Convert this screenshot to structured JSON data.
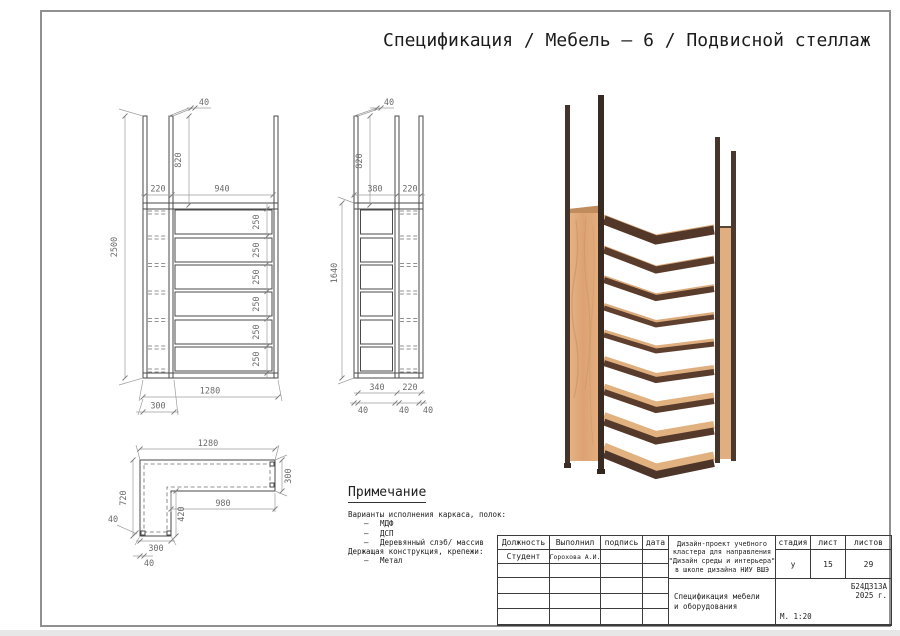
{
  "page": {
    "title": "Спецификация / Мебель – 6 / Подвисной стеллаж"
  },
  "views": {
    "front": {
      "d40": "40",
      "d820": "820",
      "d220": "220",
      "d940": "940",
      "d2500": "2500",
      "d250": "250",
      "d1280": "1280",
      "d300": "300"
    },
    "side": {
      "d40": "40",
      "d820": "820",
      "d380": "380",
      "d220": "220",
      "d1640": "1640",
      "d340": "340",
      "d220b": "220",
      "d40b": "40"
    },
    "top": {
      "d1280": "1280",
      "d300r": "300",
      "d720": "720",
      "d980": "980",
      "d420": "420",
      "d40l": "40",
      "d300b": "300",
      "d40b": "40"
    }
  },
  "notes": {
    "heading": "Примечание",
    "intro1": "Варианты исполнения каркаса, полок:",
    "bullets1": [
      "МДФ",
      "ДСП",
      "Деревянный слэб/ массив"
    ],
    "intro2": "Держащая конструкция, крепежи:",
    "bullets2": [
      "Метал"
    ],
    "dash": "–"
  },
  "titleblock": {
    "col_position": "Должность",
    "col_executor": "Выполнил",
    "col_signature": "подпись",
    "col_date": "дата",
    "role": "Студент",
    "executor_name": "Горохова А.И.",
    "project": {
      "line1": "Дизайн-проект учебного",
      "line2": "кластера для направления",
      "line3": "\"Дизайн среды и интерьера\"",
      "line4": "в школе дизайна НИУ ВШЭ"
    },
    "doc": {
      "line1": "Спецификация мебели",
      "line2": "и оборудования"
    },
    "col_stage": "стадия",
    "col_sheet": "лист",
    "col_sheets": "листов",
    "stage": "у",
    "sheet": "15",
    "sheets": "29",
    "code": "Б24Д313А",
    "year": "2025 г.",
    "scale": "М. 1:20"
  }
}
